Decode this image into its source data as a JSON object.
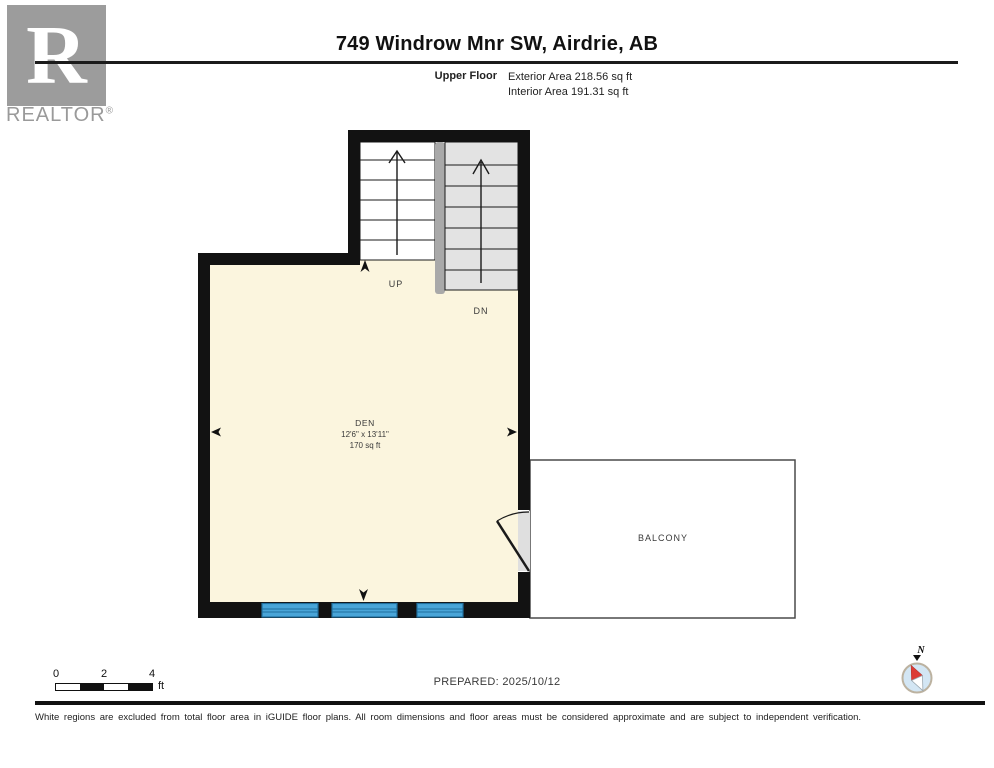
{
  "header": {
    "brand_initial": "R",
    "brand": "REALTOR",
    "brand_registered": "®",
    "title": "749 Windrow Mnr SW, Airdrie, AB",
    "floor_label": "Upper Floor",
    "exterior_area": "Exterior Area 218.56 sq ft",
    "interior_area": "Interior Area 191.31 sq ft"
  },
  "plan": {
    "room": {
      "name": "DEN",
      "dimensions": "12'6\" x 13'11\"",
      "area": "170 sq ft"
    },
    "balcony_label": "BALCONY",
    "stairs": {
      "up_label": "UP",
      "down_label": "DN"
    },
    "colors": {
      "wall": "#121212",
      "room_fill": "#FBF5DE",
      "stair_up_fill": "#FFFFFF",
      "stair_down_fill": "#E3E3E3",
      "stair_divider": "#A9A9A9",
      "window_fill": "#49A5D8",
      "window_line": "#1F6F9E",
      "door_fill": "#DFDFDF",
      "balcony_border": "#4A4A4A",
      "compass_needle": "#DC3B35",
      "compass_face": "#D3E6F4",
      "compass_ring": "#BCB2A0"
    }
  },
  "footer": {
    "scale": {
      "tick0": "0",
      "tick2": "2",
      "tick4": "4",
      "unit": "ft"
    },
    "prepared": "PREPARED: 2025/10/12",
    "compass_label": "N",
    "disclaimer": "White regions are excluded from total floor area in iGUIDE floor plans. All room dimensions and floor areas must be considered approximate and are subject to independent verification."
  }
}
